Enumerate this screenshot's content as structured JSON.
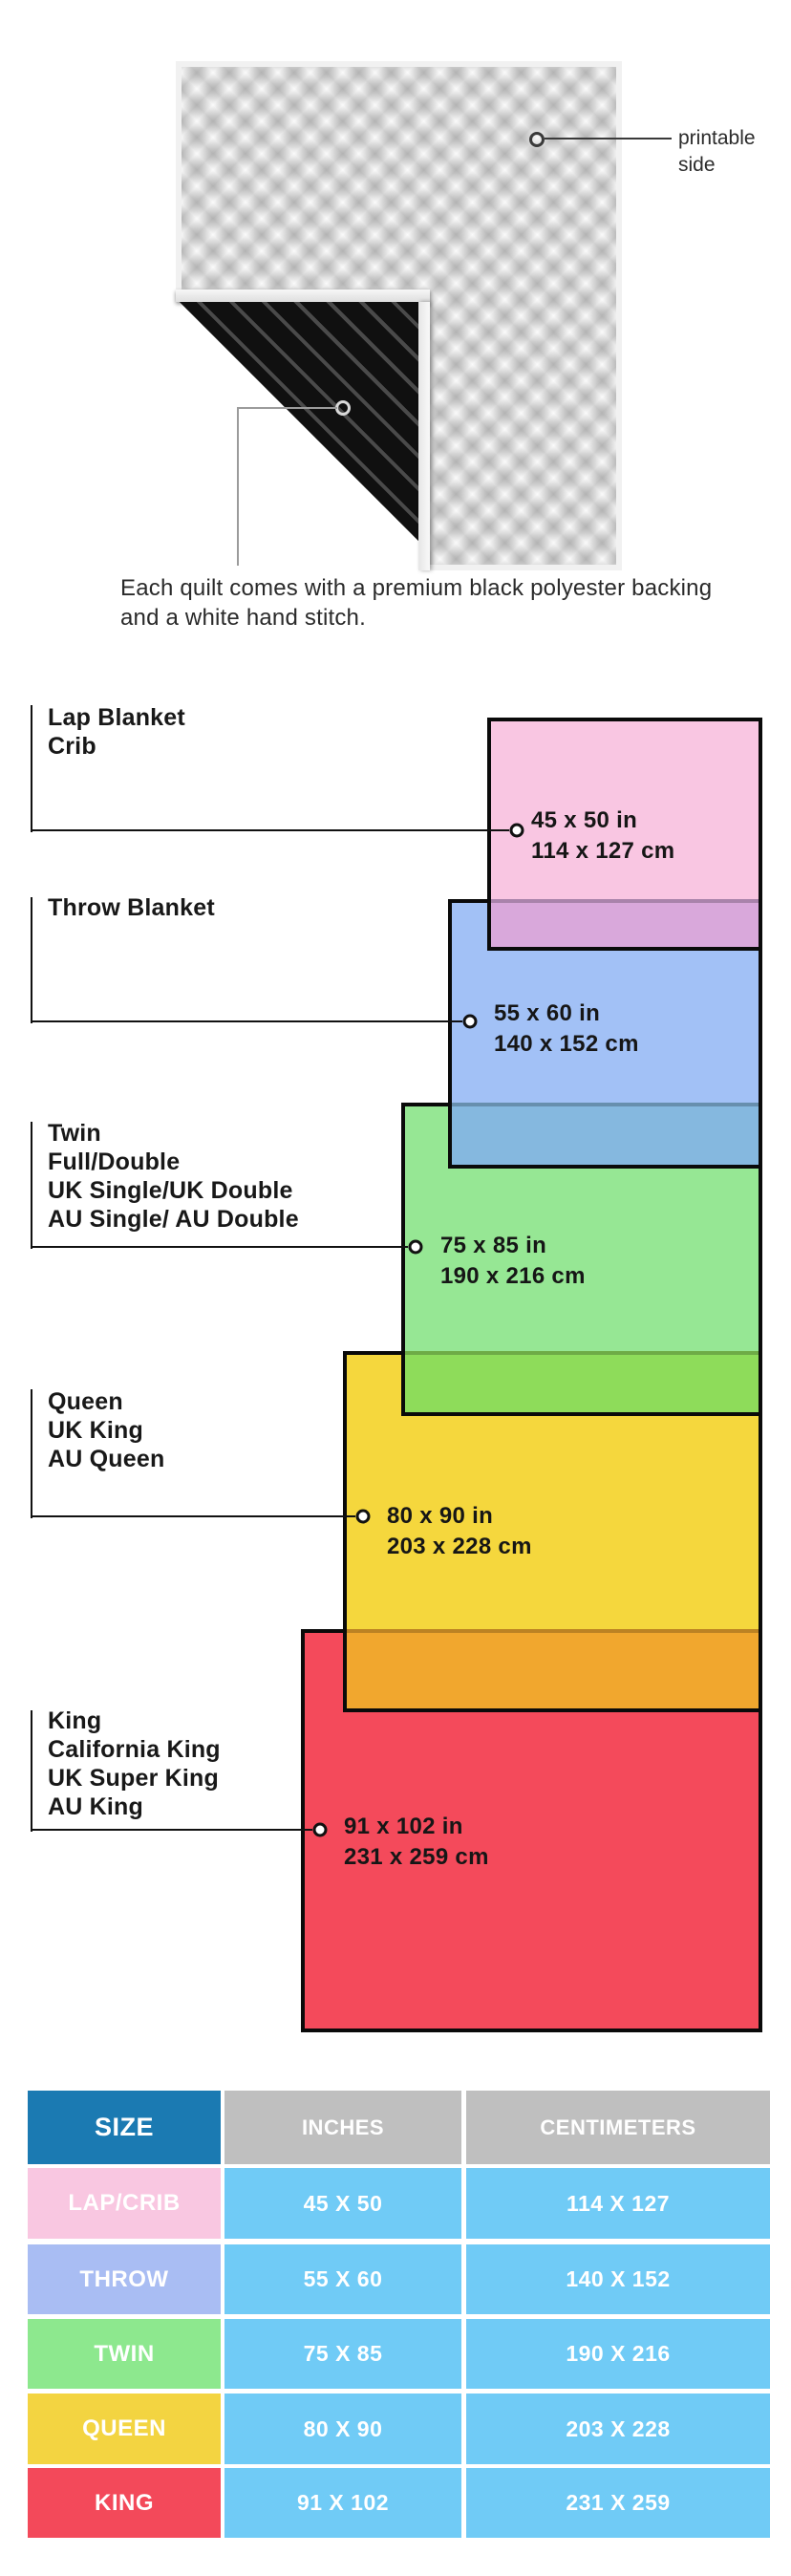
{
  "quilt": {
    "printable_label": [
      "printable",
      "side"
    ],
    "caption": "Each quilt comes with a premium black polyester backing and a white hand stitch."
  },
  "diagram": {
    "items": [
      {
        "name": "lap-crib",
        "labels": [
          "Lap Blanket",
          "Crib"
        ],
        "inches": "45 x 50 in",
        "cm": "114 x 127 cm",
        "fill": "#F9C6E2",
        "overlap_fill": "#D9A8DB"
      },
      {
        "name": "throw",
        "labels": [
          "Throw Blanket"
        ],
        "inches": "55 x 60 in",
        "cm": "140 x 152 cm",
        "fill": "#A2C1F6",
        "overlap_fill": "#85B8DF"
      },
      {
        "name": "twin",
        "labels": [
          "Twin",
          "Full/Double",
          "UK Single/UK Double",
          "AU Single/ AU Double"
        ],
        "inches": "75 x 85 in",
        "cm": "190 x 216 cm",
        "fill": "#96E794",
        "overlap_fill": "#8EDC5A"
      },
      {
        "name": "queen",
        "labels": [
          "Queen",
          "UK King",
          "AU Queen"
        ],
        "inches": "80 x 90 in",
        "cm": "203 x 228 cm",
        "fill": "#F5D73D",
        "overlap_fill": "#F1A72E"
      },
      {
        "name": "king",
        "labels": [
          "King",
          "California King",
          "UK Super King",
          "AU King"
        ],
        "inches": "91 x 102 in",
        "cm": "231 x 259 cm",
        "fill": "#F44A5B",
        "overlap_fill": null
      }
    ],
    "border_color": "#0A0A0A"
  },
  "table": {
    "headers": [
      "SIZE",
      "INCHES",
      "CENTIMETERS"
    ],
    "header_bg": {
      "size": "#1B7AB2",
      "measure": "#BFBFBF"
    },
    "cell_bg": "#70CBF6",
    "rows": [
      {
        "size": "LAP/CRIB",
        "inches": "45 X 50",
        "centimeters": "114 X 127",
        "bg": "#F9C7E1"
      },
      {
        "size": "THROW",
        "inches": "55 X 60",
        "centimeters": "140 X 152",
        "bg": "#A9BDF3"
      },
      {
        "size": "TWIN",
        "inches": "75 X 85",
        "centimeters": "190 X 216",
        "bg": "#8DE88E"
      },
      {
        "size": "QUEEN",
        "inches": "80 X 90",
        "centimeters": "203 X 228",
        "bg": "#F3D441"
      },
      {
        "size": "KING",
        "inches": "91 X 102",
        "centimeters": "231 X 259",
        "bg": "#F3495A"
      }
    ]
  }
}
